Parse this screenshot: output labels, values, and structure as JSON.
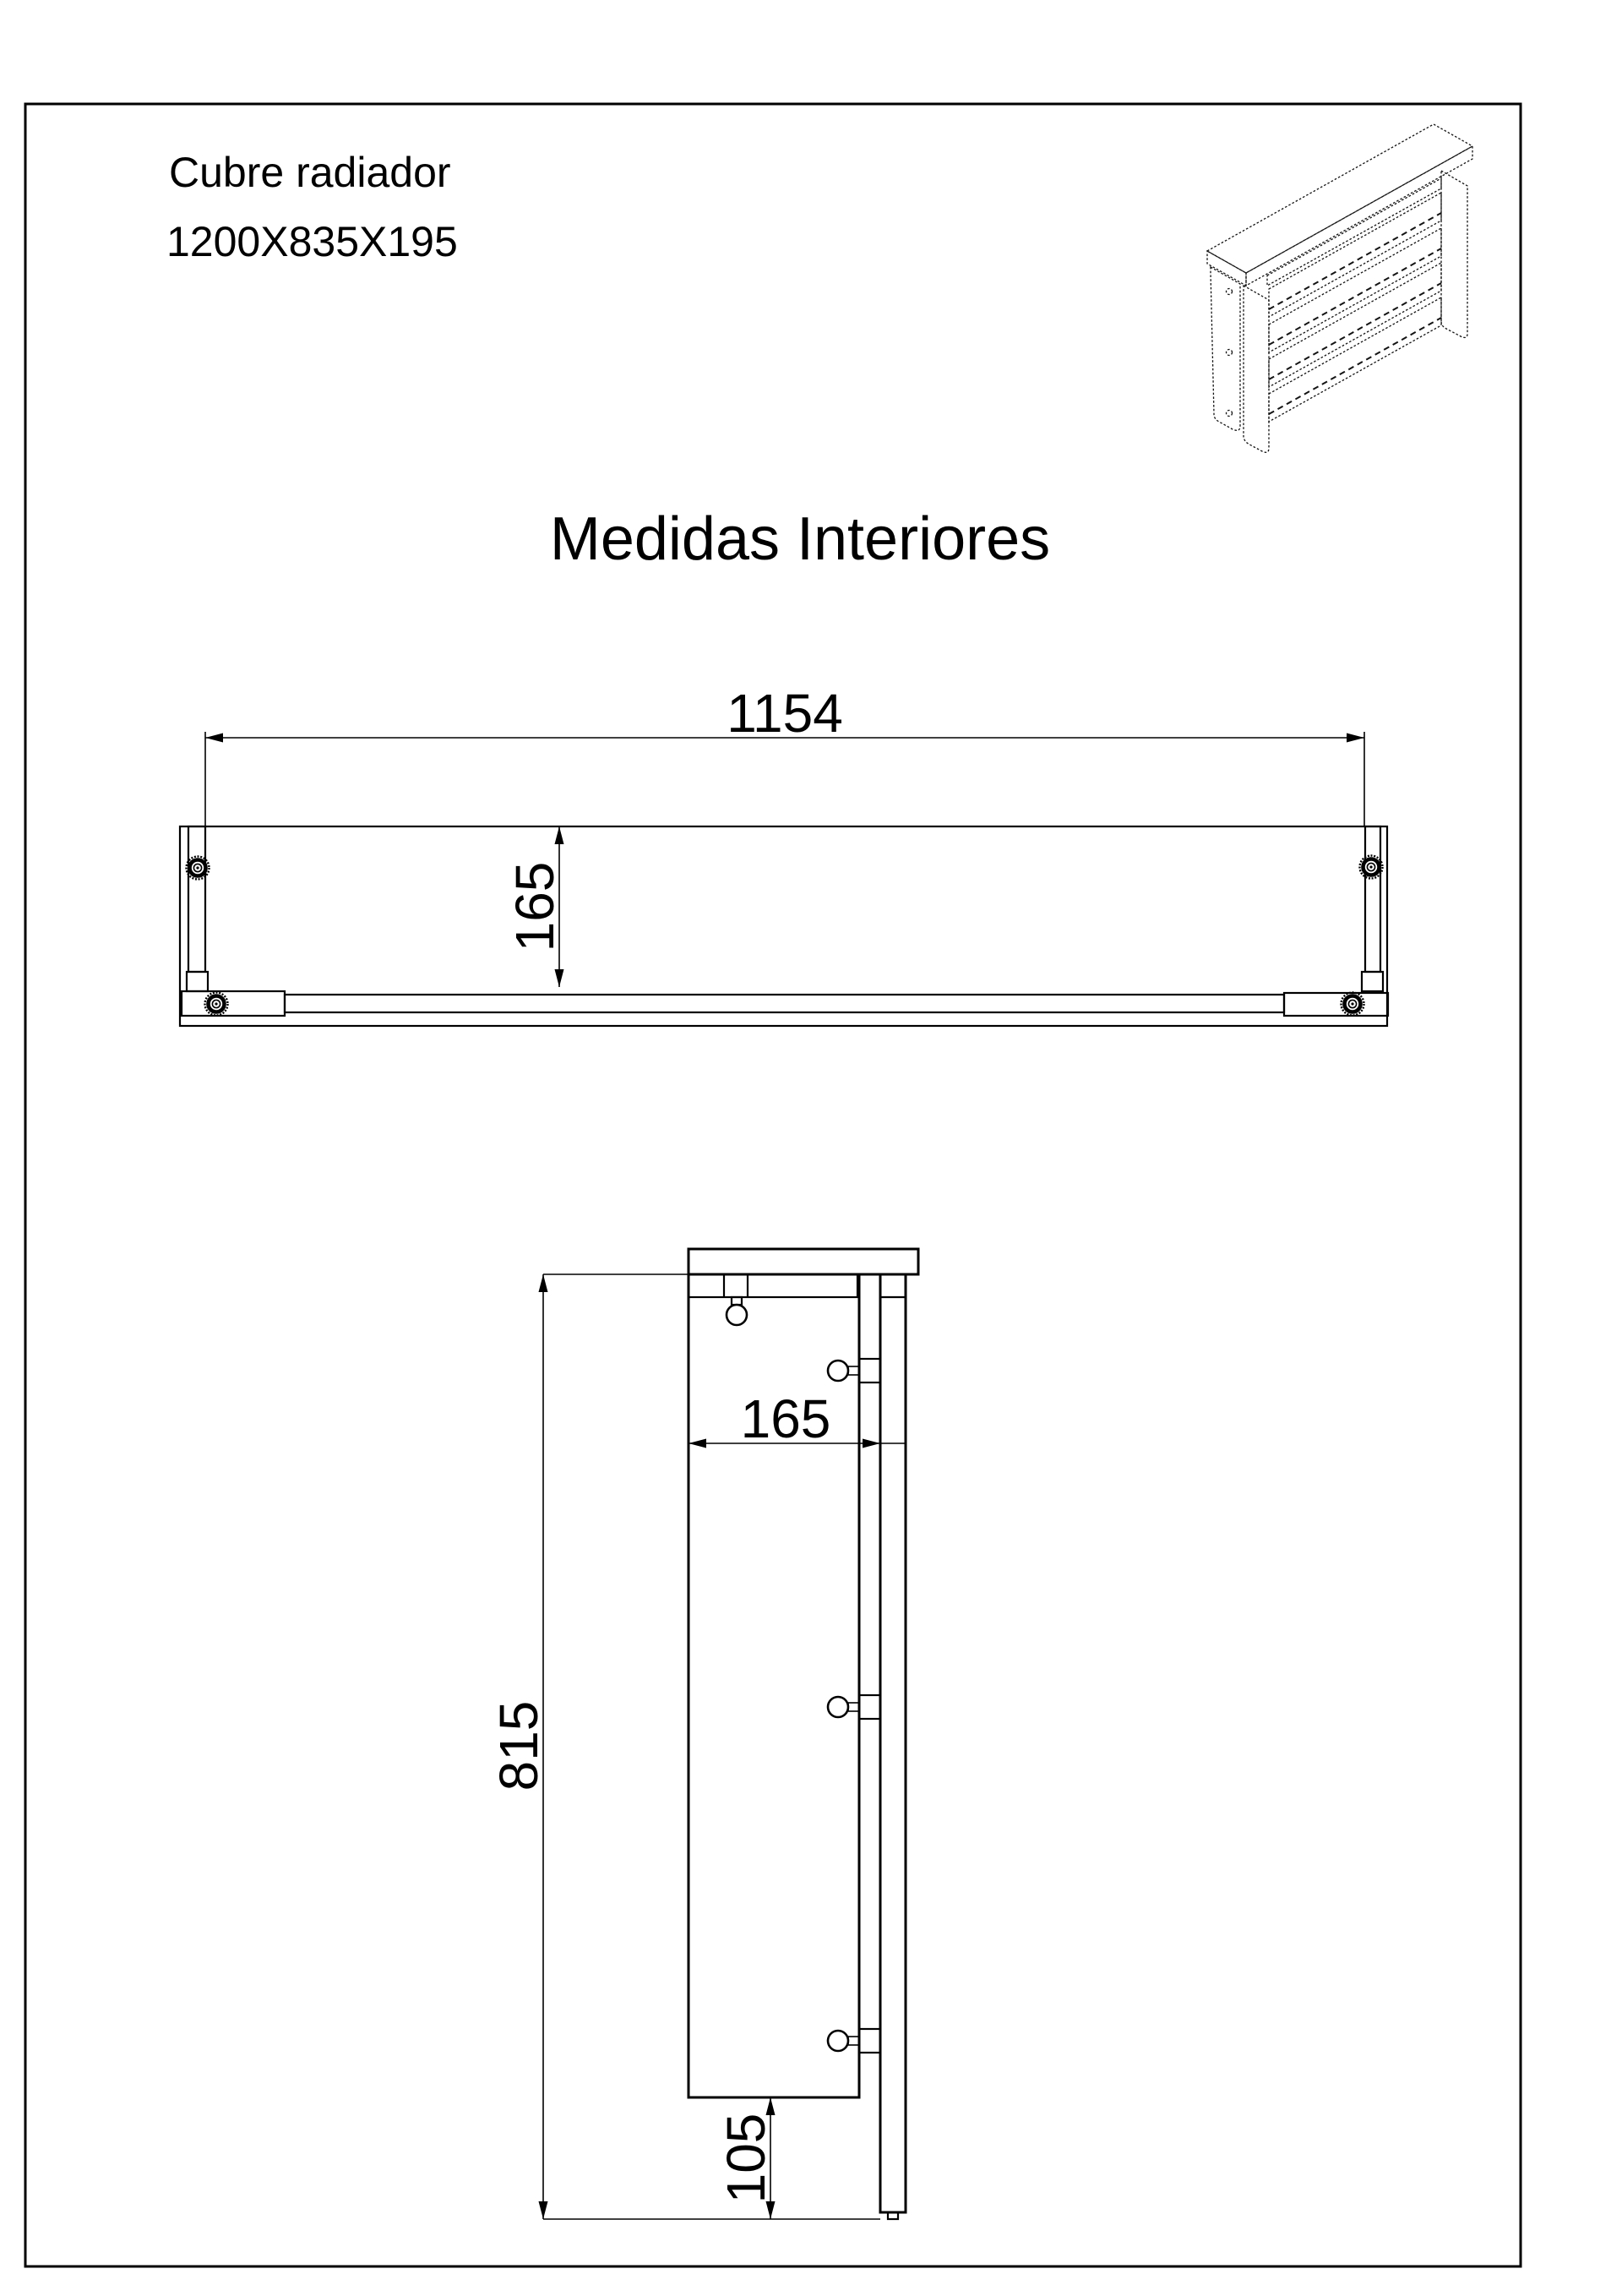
{
  "page": {
    "background": "#ffffff",
    "line_color": "#000000"
  },
  "header": {
    "product_name": "Cubre radiador",
    "product_size": "1200X835X195"
  },
  "title": "Medidas Interiores",
  "dimensions": {
    "top_width": "1154",
    "top_depth": "165",
    "side_height": "815",
    "side_depth": "165",
    "side_bottom_gap": "105"
  }
}
